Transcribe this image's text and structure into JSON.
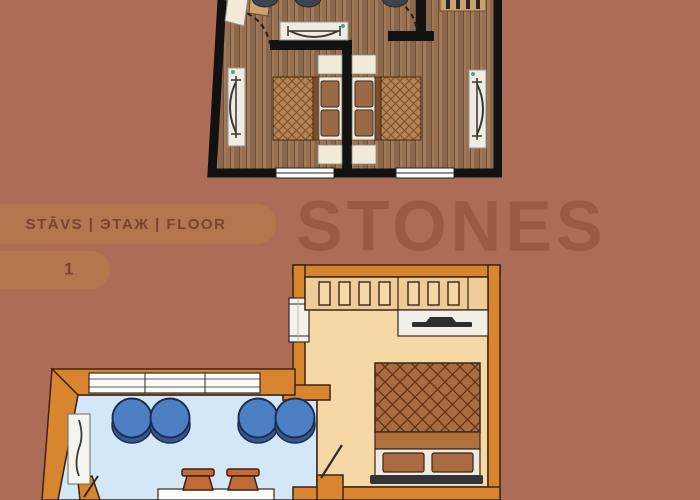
{
  "header": {
    "floor_label": "STĀVS | ЭТАЖ | FLOOR",
    "floor_number": "1",
    "watermark": "STONES"
  },
  "colors": {
    "background": "#ad6c55",
    "pill": "#b5764e",
    "pill_text": "#7b422f",
    "watermark": "#985741",
    "wall_dark": "#121212",
    "orange_wall": "#d9842f",
    "outline": "#3a2415",
    "tan_room": "#f6d8a7",
    "wardrobe_tan": "#eecb97",
    "blue_room": "#d4e7f6",
    "stool_blue": "#4d7fc4",
    "stool_shadow": "#33598f",
    "quilt_brown": "#a96b40",
    "wood_light": "#a07a5a",
    "wood_dark": "#8c684b",
    "white_furniture": "#f1ece1",
    "pot_terracotta": "#c26a36",
    "radiator_dot": "#3fae84"
  }
}
